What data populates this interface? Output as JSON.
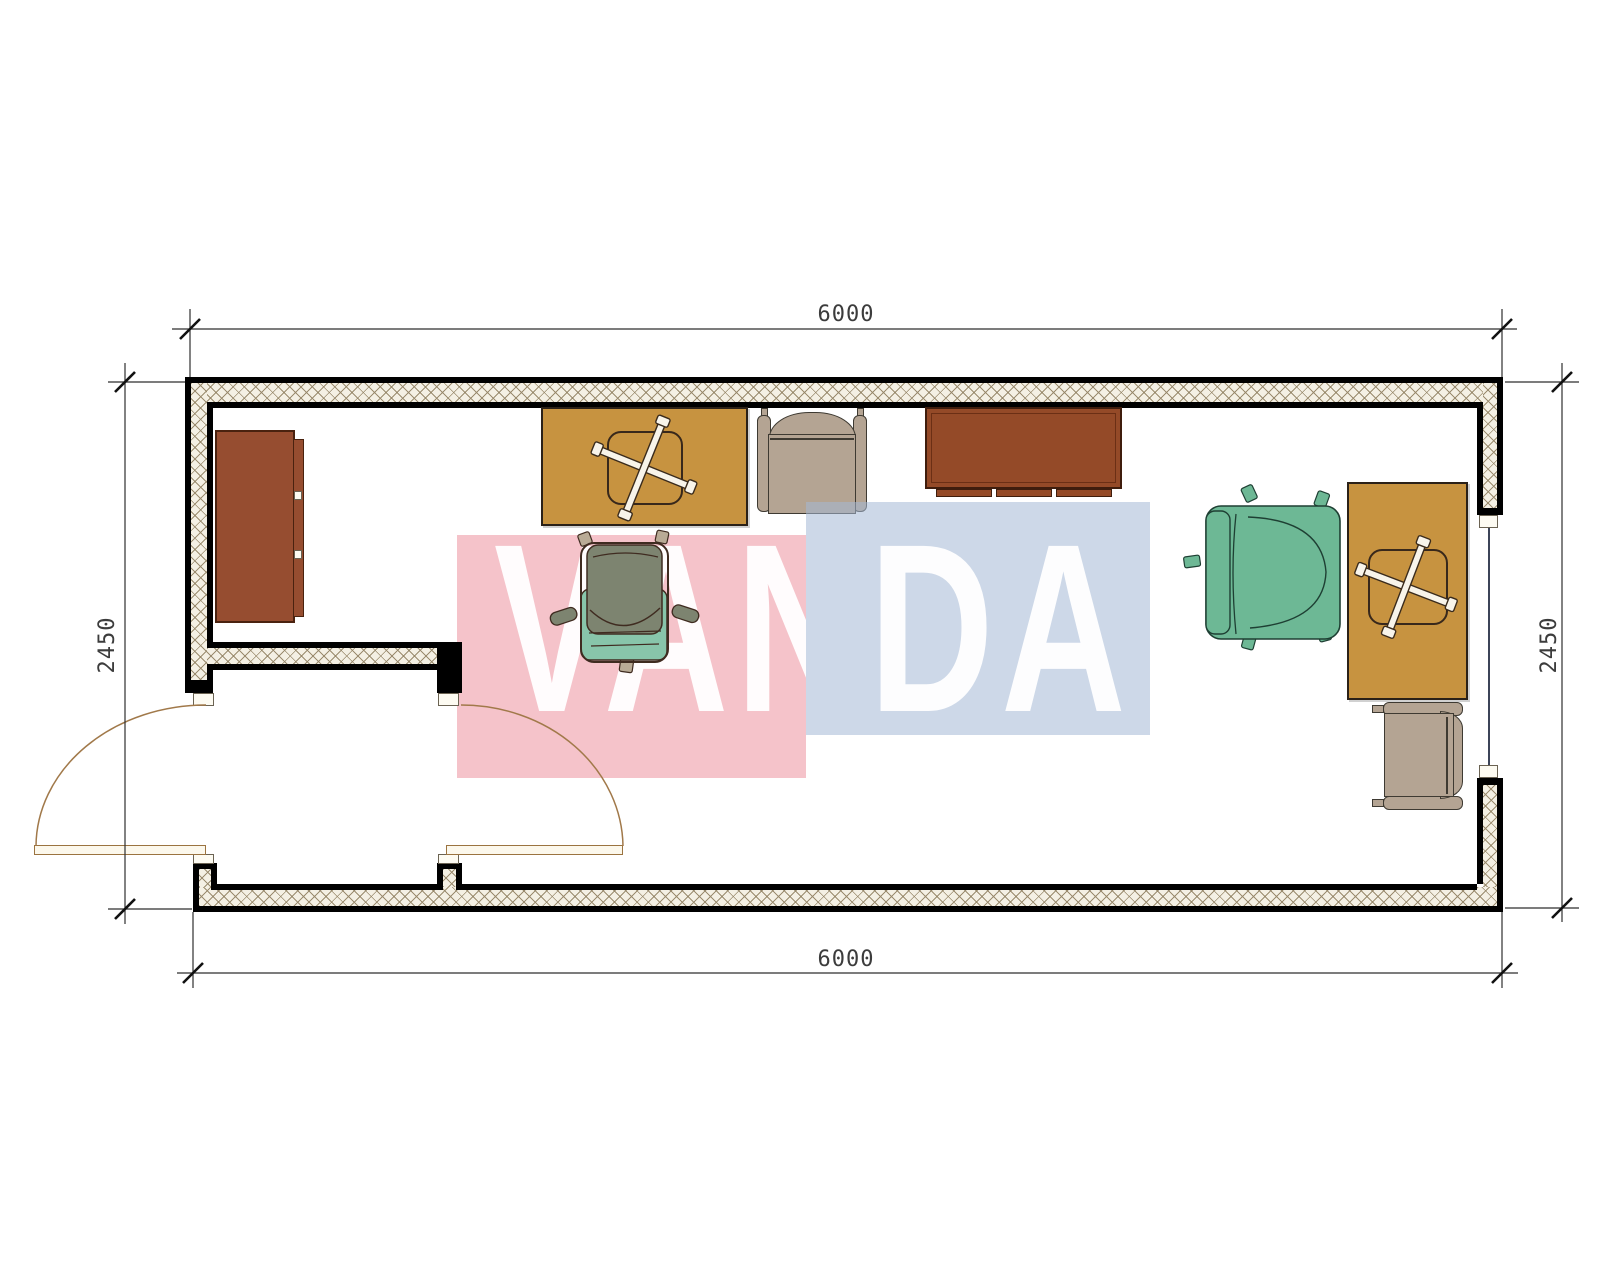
{
  "watermark": {
    "text": "VANDA",
    "text_left": "VAN",
    "text_right": "DA",
    "pink_block_color": "#f5c3ca",
    "blue_block_color": "#cdd8e8",
    "letter_color": "#ffffff"
  },
  "dimensions": {
    "top_width": "6000",
    "bottom_width": "6000",
    "left_height": "2450",
    "right_height": "2450"
  },
  "palette": {
    "wall_line": "#000000",
    "hatch_line": "#968769",
    "hatch_fill": "#f4f0e4",
    "door_arc": "#a1794a",
    "desk_tan": "#c79340",
    "cabinet_brown": "#964d30",
    "sideboard_brown": "#944a28",
    "armchair_taupe": "#b4a493",
    "task_chair_body": "#7d8470",
    "task_chair_accent": "#88c5aa",
    "task_chair_right": "#6db895",
    "window_line": "#3c4458",
    "dimension_line": "#2f2f2f"
  },
  "furniture": [
    {
      "id": "cabinet-left",
      "kind": "cabinet"
    },
    {
      "id": "desk-left",
      "kind": "desk"
    },
    {
      "id": "task-chair-center",
      "kind": "office-chair"
    },
    {
      "id": "armchair-top",
      "kind": "armchair"
    },
    {
      "id": "sideboard-top",
      "kind": "sideboard"
    },
    {
      "id": "task-chair-right",
      "kind": "office-chair"
    },
    {
      "id": "desk-right",
      "kind": "desk"
    },
    {
      "id": "armchair-bottom-right",
      "kind": "armchair"
    }
  ]
}
